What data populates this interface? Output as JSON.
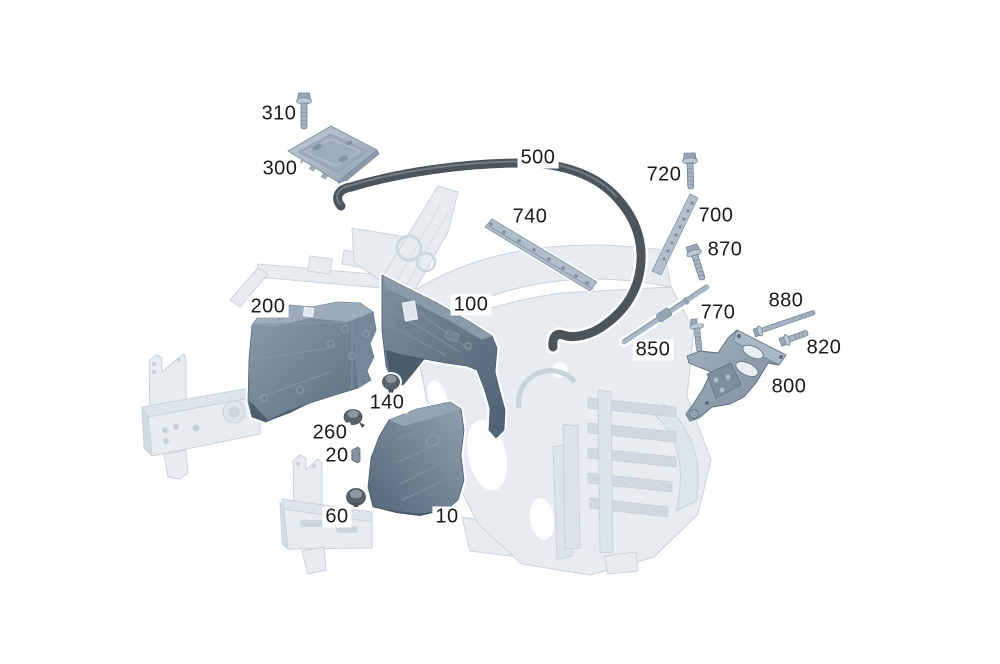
{
  "diagram": {
    "type": "exploded-parts-diagram",
    "background_color": "#ffffff",
    "colors": {
      "label_text": "#191919",
      "label_background": "#ffffff",
      "part_outline": "#ffffff",
      "panel_base": "#66788a",
      "panel_light": "#93a4b3",
      "panel_dark": "#4f6071",
      "hardware": "#a6b4c2",
      "hardware_edge": "#6e7e8e",
      "seal": "#4c545c",
      "clip": "#59626b",
      "background_structure": "#e7ecf1",
      "background_structure_edge": "#c9d3dc"
    },
    "callouts": [
      {
        "label": "310",
        "x": 279,
        "y": 114
      },
      {
        "label": "300",
        "x": 280,
        "y": 169
      },
      {
        "label": "500",
        "x": 538,
        "y": 158
      },
      {
        "label": "720",
        "x": 664,
        "y": 175
      },
      {
        "label": "740",
        "x": 530,
        "y": 217
      },
      {
        "label": "700",
        "x": 716,
        "y": 216
      },
      {
        "label": "870",
        "x": 725,
        "y": 250
      },
      {
        "label": "200",
        "x": 268,
        "y": 307
      },
      {
        "label": "100",
        "x": 471,
        "y": 305
      },
      {
        "label": "880",
        "x": 786,
        "y": 301
      },
      {
        "label": "770",
        "x": 718,
        "y": 313
      },
      {
        "label": "850",
        "x": 653,
        "y": 350
      },
      {
        "label": "820",
        "x": 824,
        "y": 348
      },
      {
        "label": "800",
        "x": 789,
        "y": 387
      },
      {
        "label": "140",
        "x": 387,
        "y": 403
      },
      {
        "label": "260",
        "x": 330,
        "y": 433
      },
      {
        "label": "20",
        "x": 337,
        "y": 456
      },
      {
        "label": "60",
        "x": 337,
        "y": 517
      },
      {
        "label": "10",
        "x": 447,
        "y": 517
      }
    ]
  }
}
